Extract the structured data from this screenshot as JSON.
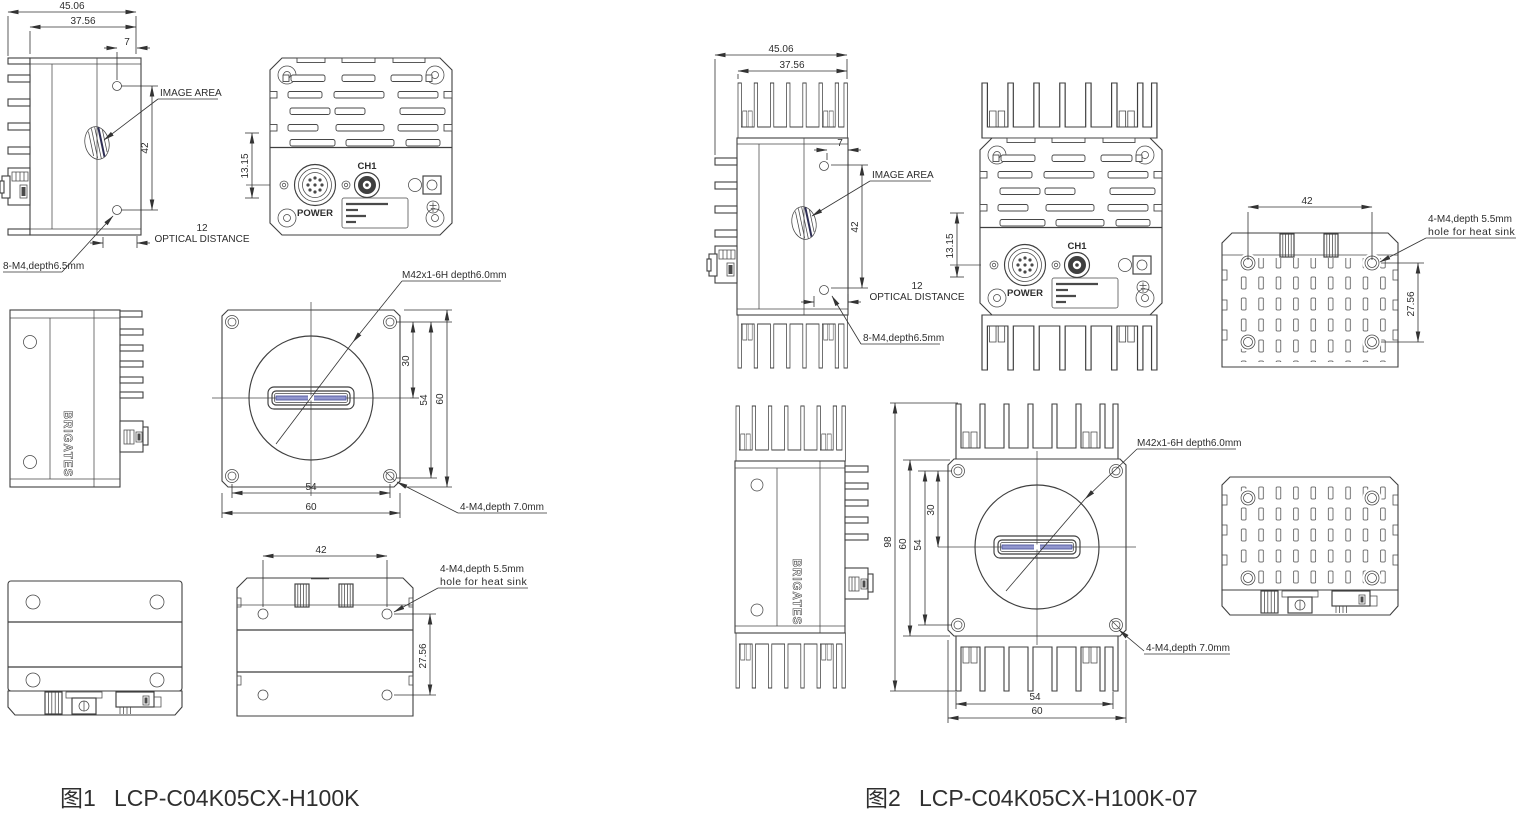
{
  "figure1": {
    "label": "图1",
    "model": "LCP-C04K05CX-H100K",
    "brand": "BRIGATES",
    "rear": {
      "ch1": "CH1",
      "power": "POWER"
    },
    "dims": {
      "total_width": "45.06",
      "body_width": "37.56",
      "hole_offset": "7",
      "hole_spacing": "42",
      "connector_height": "13.15",
      "optical_distance": "12",
      "optical_distance_label": "OPTICAL DISTANCE",
      "front_center": "30",
      "front_hole_spacing": "54",
      "front_size": "60",
      "bottom_hole_spacing": "54",
      "bottom_size": "60",
      "top_hole_spacing": "42",
      "top_hole_spacing_v": "27.56"
    },
    "notes": {
      "image_area": "IMAGE AREA",
      "side_screws": "8-M4,depth6.5mm",
      "lens_mount": "M42x1-6H depth6.0mm",
      "front_screws": "4-M4,depth 7.0mm",
      "heatsink_screws_line1": "4-M4,depth 5.5mm",
      "heatsink_screws_line2": "hole for heat sink"
    }
  },
  "figure2": {
    "label": "图2",
    "model": "LCP-C04K05CX-H100K-07",
    "brand": "BRIGATES",
    "rear": {
      "ch1": "CH1",
      "power": "POWER"
    },
    "dims": {
      "total_width": "45.06",
      "body_width": "37.56",
      "hole_offset": "7",
      "hole_spacing": "42",
      "connector_height": "13.15",
      "optical_distance": "12",
      "optical_distance_label": "OPTICAL DISTANCE",
      "total_height": "98",
      "front_center": "30",
      "front_hole_spacing": "54",
      "front_size": "60",
      "bottom_hole_spacing": "54",
      "bottom_size": "60",
      "top_hole_spacing": "42",
      "top_hole_spacing_v": "27.56"
    },
    "notes": {
      "image_area": "IMAGE AREA",
      "side_screws": "8-M4,depth6.5mm",
      "lens_mount": "M42x1-6H depth6.0mm",
      "front_screws": "4-M4,depth 7.0mm",
      "heatsink_screws_line1": "4-M4,depth 5.5mm",
      "heatsink_screws_line2": "hole for heat sink"
    }
  },
  "colors": {
    "line": "#3f3f3f",
    "sensor_blue": "#9196ce"
  }
}
